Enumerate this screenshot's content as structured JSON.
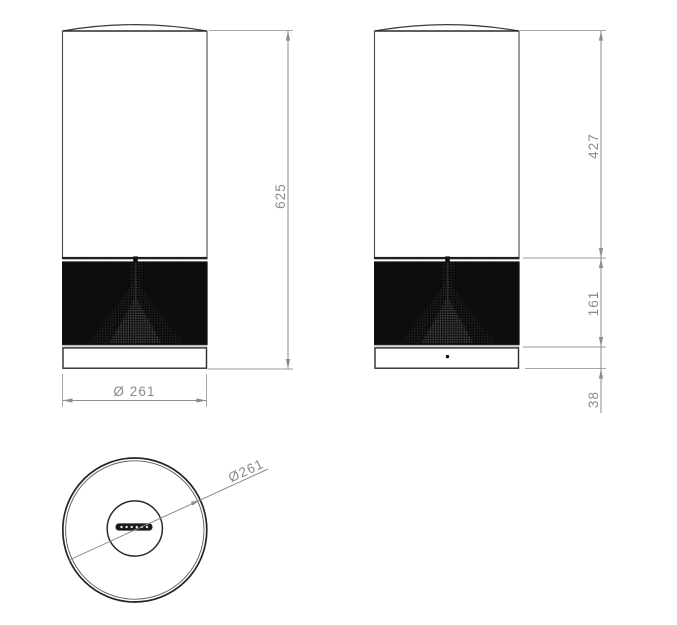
{
  "palette": {
    "background": "#ffffff",
    "outline": "#2b2b2b",
    "grille": "#0c0c0c",
    "grille_top_bar": "#1f1f1f",
    "base_strip": "#dedede",
    "dim_line": "#8c8c8c",
    "dim_text": "#8a8a8a"
  },
  "dimensions": {
    "total_height": "625",
    "upper_body_height": "427",
    "grille_height": "161",
    "base_height": "38",
    "front_diameter": "Ø 261",
    "top_diameter": "Ø261"
  }
}
